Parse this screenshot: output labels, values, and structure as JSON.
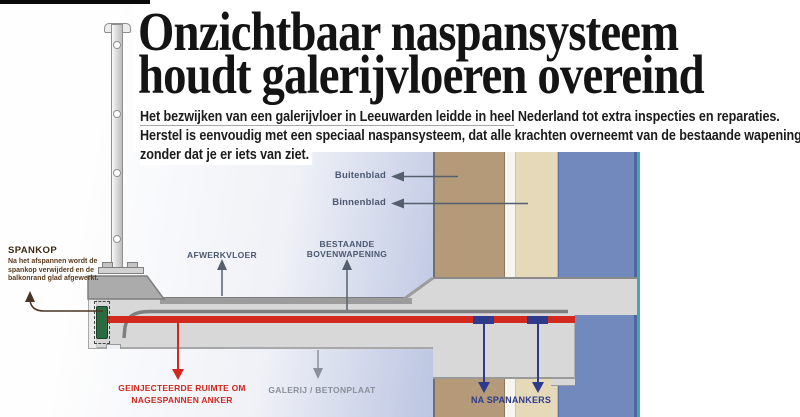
{
  "masthead": {
    "title_line1": "Onzichtbaar naspansysteem",
    "title_line2": "houdt galerijvloeren overeind",
    "intro_line1a": "Het bezwijken van een galerijvloer in Leeuwarden leidde in heel",
    "intro_line1b": " Nederland tot extra inspecties en reparaties.",
    "intro_line2": "Herstel is eenvoudig met een speciaal naspansysteem, dat alle krachten overneemt van de bestaande wapening,",
    "intro_line3": "zonder dat je er iets van ziet."
  },
  "diagram": {
    "labels": {
      "spankop_title": "SPANKOP",
      "spankop_line1": "Na het afspannen wordt de",
      "spankop_line2": "spankop verwijderd en de",
      "spankop_line3": "balkonrand glad afgewerkt.",
      "afwerkvloer": "AFWERKVLOER",
      "bovenwapening_line1": "BESTAANDE",
      "bovenwapening_line2": "BOVENWAPENING",
      "buitenblad": "Buitenblad",
      "binnenblad": "Binnenblad",
      "geinjecteerde_line1": "GEINJECTEERDE RUIMTE OM",
      "geinjecteerde_line2": "NAGESPANNEN ANKER",
      "galerij": "GALERIJ / BETONPLAAT",
      "naspanankers": "NA SPANANKERS"
    }
  },
  "colors": {
    "accent_red": "#d2281e",
    "navy": "#2e3a8c",
    "slate": "#4a5872",
    "label_gray": "#8a8f99",
    "brown_band": "#b49a79",
    "cream_band": "#e5d9ba",
    "blue_band": "#7289be",
    "blue_edge": "#4d66a2",
    "teal_border": "#47a7ad",
    "slab_gray": "#d8d8d8",
    "screed_gray": "#9c9c9c",
    "upstand_gray": "#ababab",
    "anchor_green": "#2c6b40",
    "spankop_brown": "#5a3b1d",
    "headline_black": "#141414"
  }
}
